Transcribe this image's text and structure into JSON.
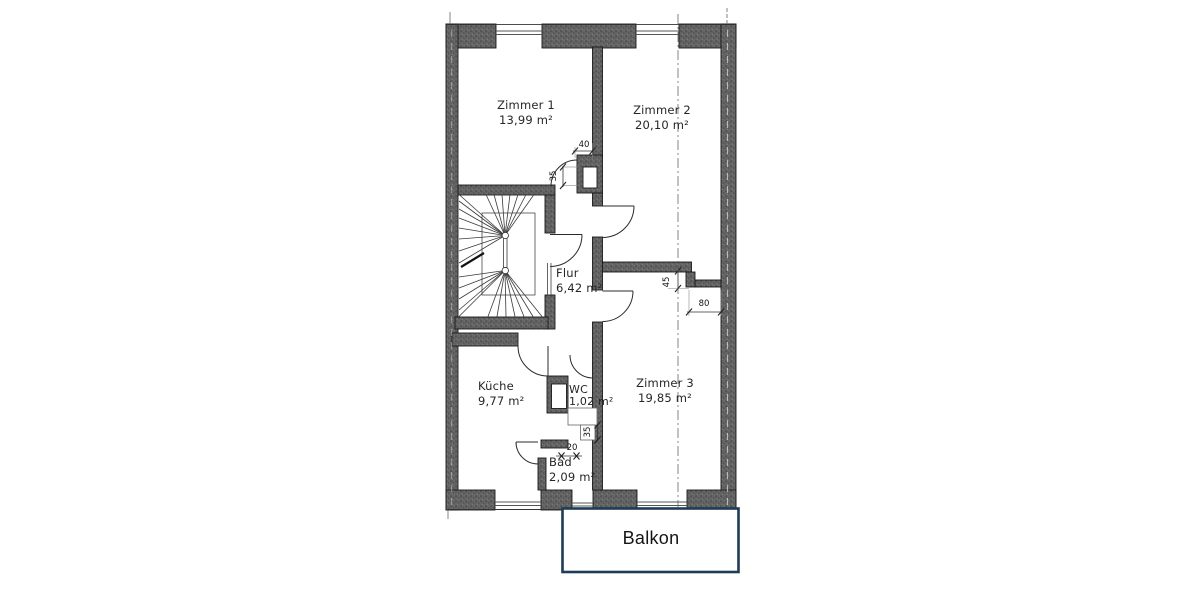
{
  "floor_plan": {
    "rooms": {
      "zimmer1": {
        "name": "Zimmer 1",
        "area": "13,99 m²"
      },
      "zimmer2": {
        "name": "Zimmer 2",
        "area": "20,10 m²"
      },
      "zimmer3": {
        "name": "Zimmer 3",
        "area": "19,85 m²"
      },
      "flur": {
        "name": "Flur",
        "area": "6,42 m²"
      },
      "kueche": {
        "name": "Küche",
        "area": "9,77 m²"
      },
      "wc": {
        "name": "WC",
        "area": "1,02 m²"
      },
      "bad": {
        "name": "Bad",
        "area": "2,09 m²"
      },
      "balkon": {
        "name": "Balkon"
      }
    },
    "dimensions_cm": {
      "door_niche_width": "40",
      "shaft_depth": "35",
      "wall_return_depth": "45",
      "opening_width": "80",
      "wc_wall_depth": "35",
      "bad_wall_width": "20"
    },
    "colors": {
      "wall_fill": "#616161",
      "outline": "#1a1a1a",
      "balkon_border": "#1f3b55",
      "dimension_text": "#101010"
    }
  }
}
